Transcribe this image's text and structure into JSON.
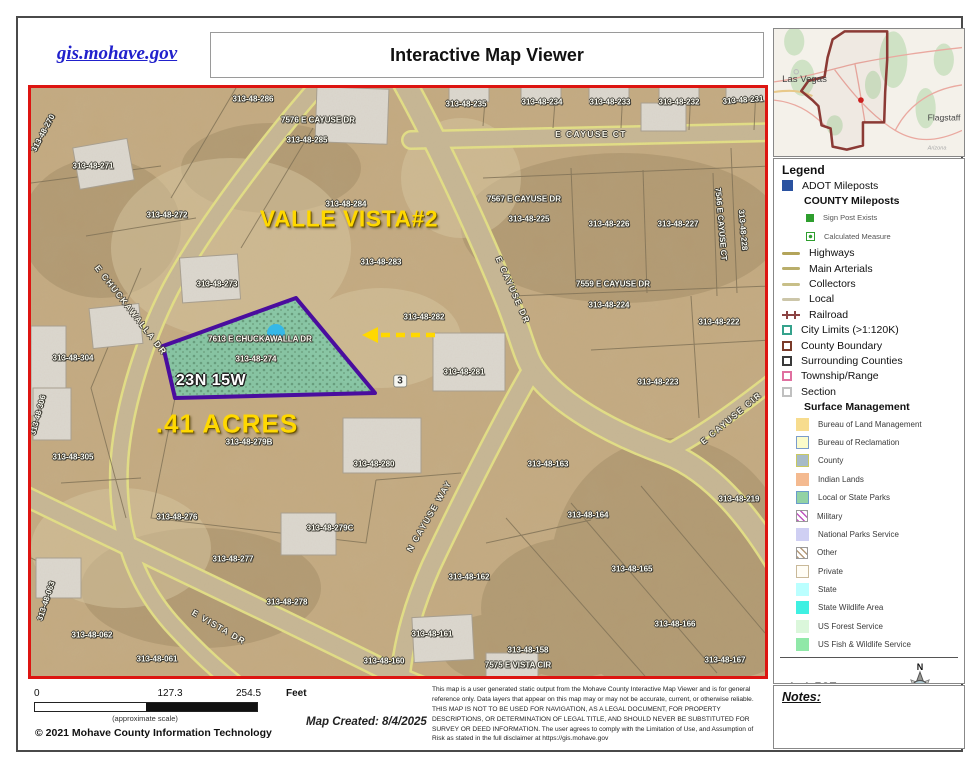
{
  "header": {
    "site_link": "gis.mohave.gov",
    "title": "Interactive Map Viewer"
  },
  "inset": {
    "las_vegas": "Las Vegas",
    "flagstaff": "Flagstaff",
    "arizona": "Arizona"
  },
  "legend": {
    "title": "Legend",
    "scale_ratio": "1: 1,527",
    "compass": {
      "n": "N",
      "s": "S",
      "e": "E",
      "w": "W"
    },
    "items": [
      {
        "label": "ADOT Mileposts",
        "icon": "fill",
        "color": "#2a52a0"
      },
      {
        "label": "COUNTY Mileposts",
        "icon": "none",
        "header": true
      },
      {
        "label": "Sign Post Exists",
        "icon": "dot",
        "color": "#2e9e2e",
        "indent": 2
      },
      {
        "label": "Calculated Measure",
        "icon": "calc",
        "color": "#2e9e2e",
        "indent": 2
      },
      {
        "label": "Highways",
        "icon": "line",
        "color": "#b3a45a"
      },
      {
        "label": "Main Arterials",
        "icon": "line",
        "color": "#b9ae6b"
      },
      {
        "label": "Collectors",
        "icon": "line",
        "color": "#c8bf88"
      },
      {
        "label": "Local",
        "icon": "line",
        "color": "#ccc6a9"
      },
      {
        "label": "Railroad",
        "icon": "rail",
        "color": "#8b4343"
      },
      {
        "label": "City Limits (>1:120K)",
        "icon": "outline",
        "color": "#35a28c"
      },
      {
        "label": "County Boundary",
        "icon": "outline",
        "color": "#7a3b2a"
      },
      {
        "label": "Surrounding Counties",
        "icon": "outline",
        "color": "#3a3a3a"
      },
      {
        "label": "Township/Range",
        "icon": "odash",
        "color": "#e070a0"
      },
      {
        "label": "Section",
        "icon": "outline",
        "color": "#c0c0c0"
      },
      {
        "label": "Surface Management",
        "icon": "none",
        "header": true
      },
      {
        "label": "Bureau of Land Management",
        "icon": "fill",
        "color": "#f7dc8e",
        "indent": 1
      },
      {
        "label": "Bureau of Reclamation",
        "icon": "fillb",
        "color": "#fbfbca",
        "border": "#7a9ccb",
        "indent": 1
      },
      {
        "label": "County",
        "icon": "fillb",
        "color": "#a7bbc7",
        "border": "#c9c961",
        "indent": 1
      },
      {
        "label": "Indian Lands",
        "icon": "fill",
        "color": "#f4ba90",
        "indent": 1
      },
      {
        "label": "Local or State Parks",
        "icon": "fillb",
        "color": "#92d2a4",
        "border": "#6a9ccb",
        "indent": 1
      },
      {
        "label": "Military",
        "icon": "hatch",
        "color": "#c055c0",
        "indent": 1
      },
      {
        "label": "National Parks Service",
        "icon": "fill",
        "color": "#cfcff3",
        "indent": 1
      },
      {
        "label": "Other",
        "icon": "hatch",
        "color": "#b49a7a",
        "indent": 1
      },
      {
        "label": "Private",
        "icon": "fillb",
        "color": "#fffdf6",
        "border": "#c9b999",
        "indent": 1
      },
      {
        "label": "State",
        "icon": "fill",
        "color": "#baffff",
        "indent": 1
      },
      {
        "label": "State Wildlife Area",
        "icon": "fill",
        "color": "#3ff0e2",
        "indent": 1
      },
      {
        "label": "US Forest Service",
        "icon": "fill",
        "color": "#dbf7db",
        "indent": 1
      },
      {
        "label": "US Fish & Wildlife Service",
        "icon": "fill",
        "color": "#90e8a8",
        "indent": 1
      }
    ]
  },
  "notes": {
    "label": "Notes:"
  },
  "footer": {
    "scale_labels": [
      "0",
      "127.3",
      "254.5"
    ],
    "unit": "Feet",
    "approx": "(approximate scale)",
    "copyright": "© 2021 Mohave County Information Technology",
    "created": "Map Created: 8/4/2025",
    "disclaimer": "This map is a user generated static output from the Mohave County Interactive Map Viewer and is for general reference only. Data layers that appear on this map may or may not be accurate, current, or otherwise reliable. THIS MAP IS NOT TO BE USED FOR NAVIGATION, AS A LEGAL DOCUMENT, FOR PROPERTY DESCRIPTIONS, OR DETERMINATION OF LEGAL TITLE, AND SHOULD NEVER BE SUBSTITUTED FOR SURVEY OR DEED INFORMATION. The user agrees to comply with the Limitation of Use, and Assumption of Risk as stated in the full disclaimer at https://gis.mohave.gov"
  },
  "map": {
    "colors": {
      "border_red": "#dd1511",
      "highlight_outline": "#4a0d9e",
      "highlight_fill": "#7cc8a8",
      "annotation_yellow": "#ffd800",
      "selected_point_blue": "#35b8e8"
    },
    "labels": [
      {
        "t": "313-48-270",
        "x": 12,
        "y": 45,
        "r": -62,
        "c": "p"
      },
      {
        "t": "313-48-271",
        "x": 62,
        "y": 78,
        "c": "p"
      },
      {
        "t": "313-48-272",
        "x": 136,
        "y": 127,
        "c": "p"
      },
      {
        "t": "313-48-273",
        "x": 186,
        "y": 196,
        "c": "p"
      },
      {
        "t": "313-48-286",
        "x": 222,
        "y": 11,
        "c": "p"
      },
      {
        "t": "7576 E CAYUSE DR",
        "x": 287,
        "y": 32,
        "c": "p"
      },
      {
        "t": "313-48-285",
        "x": 276,
        "y": 52,
        "c": "p"
      },
      {
        "t": "313-48-284",
        "x": 315,
        "y": 116,
        "c": "p"
      },
      {
        "t": "VALLE VISTA#2",
        "x": 318,
        "y": 131,
        "c": "vy"
      },
      {
        "t": "313-48-283",
        "x": 350,
        "y": 174,
        "c": "p"
      },
      {
        "t": "313-48-235",
        "x": 435,
        "y": 16,
        "c": "p"
      },
      {
        "t": "313-48-234",
        "x": 511,
        "y": 14,
        "c": "p"
      },
      {
        "t": "313-48-233",
        "x": 579,
        "y": 14,
        "c": "p"
      },
      {
        "t": "313-48-232",
        "x": 648,
        "y": 14,
        "c": "p"
      },
      {
        "t": "313-48-231",
        "x": 712,
        "y": 12,
        "r": -4,
        "c": "p"
      },
      {
        "t": "E CAYUSE CT",
        "x": 560,
        "y": 46,
        "c": "s"
      },
      {
        "t": "7567 E CAYUSE DR",
        "x": 493,
        "y": 111,
        "c": "p"
      },
      {
        "t": "313-48-225",
        "x": 498,
        "y": 131,
        "c": "p"
      },
      {
        "t": "313-48-226",
        "x": 578,
        "y": 136,
        "c": "p"
      },
      {
        "t": "313-48-227",
        "x": 647,
        "y": 136,
        "c": "p"
      },
      {
        "t": "7546 E CAYUSE CT",
        "x": 690,
        "y": 136,
        "r": 85,
        "c": "p"
      },
      {
        "t": "313-48-228",
        "x": 712,
        "y": 142,
        "r": 85,
        "c": "p"
      },
      {
        "t": "7559 E CAYUSE DR",
        "x": 582,
        "y": 196,
        "c": "p"
      },
      {
        "t": "313-48-224",
        "x": 578,
        "y": 217,
        "c": "p"
      },
      {
        "t": "313-48-222",
        "x": 688,
        "y": 234,
        "c": "p"
      },
      {
        "t": "313-48-223",
        "x": 627,
        "y": 294,
        "c": "p"
      },
      {
        "t": "E CAYUSE DR",
        "x": 482,
        "y": 202,
        "r": 66,
        "c": "s"
      },
      {
        "t": "313-48-282",
        "x": 393,
        "y": 229,
        "c": "p"
      },
      {
        "t": "313-48-281",
        "x": 433,
        "y": 284,
        "c": "p"
      },
      {
        "t": "3",
        "x": 369,
        "y": 293,
        "c": "box"
      },
      {
        "t": "7613 E CHUCKAWALLA DR",
        "x": 229,
        "y": 251,
        "c": "p"
      },
      {
        "t": "313-48-274",
        "x": 225,
        "y": 271,
        "c": "p"
      },
      {
        "t": "23N 15W",
        "x": 180,
        "y": 293,
        "c": "wb"
      },
      {
        "t": ".41 ACRES",
        "x": 196,
        "y": 336,
        "c": "vh"
      },
      {
        "t": "313-48-279B",
        "x": 218,
        "y": 354,
        "c": "p"
      },
      {
        "t": "313-48-280",
        "x": 343,
        "y": 376,
        "c": "p"
      },
      {
        "t": "N CAYUSE WAY",
        "x": 398,
        "y": 428,
        "r": -60,
        "c": "s"
      },
      {
        "t": "313-48-279C",
        "x": 299,
        "y": 440,
        "c": "p"
      },
      {
        "t": "313-48-276",
        "x": 146,
        "y": 429,
        "c": "p"
      },
      {
        "t": "313-48-277",
        "x": 202,
        "y": 471,
        "c": "p"
      },
      {
        "t": "313-48-278",
        "x": 256,
        "y": 514,
        "c": "p"
      },
      {
        "t": "E VISTA DR",
        "x": 188,
        "y": 539,
        "r": 30,
        "c": "s"
      },
      {
        "t": "313-48-304",
        "x": 42,
        "y": 270,
        "c": "p"
      },
      {
        "t": "313-48-306",
        "x": 7,
        "y": 327,
        "r": -75,
        "c": "p"
      },
      {
        "t": "313-48-305",
        "x": 42,
        "y": 369,
        "c": "p"
      },
      {
        "t": "313-48-063",
        "x": 15,
        "y": 513,
        "r": -72,
        "c": "p"
      },
      {
        "t": "313-48-062",
        "x": 61,
        "y": 547,
        "c": "p"
      },
      {
        "t": "313-48-061",
        "x": 126,
        "y": 571,
        "c": "p"
      },
      {
        "t": "E CHUCKAWALLA DR",
        "x": 100,
        "y": 222,
        "r": 52,
        "c": "s"
      },
      {
        "t": "313-48-163",
        "x": 517,
        "y": 376,
        "c": "p"
      },
      {
        "t": "313-48-164",
        "x": 557,
        "y": 427,
        "c": "p"
      },
      {
        "t": "313-48-165",
        "x": 601,
        "y": 481,
        "c": "p"
      },
      {
        "t": "313-48-166",
        "x": 644,
        "y": 536,
        "c": "p"
      },
      {
        "t": "313-48-167",
        "x": 694,
        "y": 572,
        "c": "p"
      },
      {
        "t": "313-48-219",
        "x": 708,
        "y": 411,
        "c": "p"
      },
      {
        "t": "E CAYUSE CIR",
        "x": 700,
        "y": 330,
        "r": -40,
        "c": "s"
      },
      {
        "t": "313-48-162",
        "x": 438,
        "y": 489,
        "c": "p"
      },
      {
        "t": "313-48-161",
        "x": 401,
        "y": 546,
        "c": "p"
      },
      {
        "t": "313-48-160",
        "x": 353,
        "y": 573,
        "c": "p"
      },
      {
        "t": "313-48-158",
        "x": 497,
        "y": 562,
        "c": "p"
      },
      {
        "t": "7575 E VISTA CIR",
        "x": 487,
        "y": 577,
        "c": "p"
      }
    ]
  }
}
